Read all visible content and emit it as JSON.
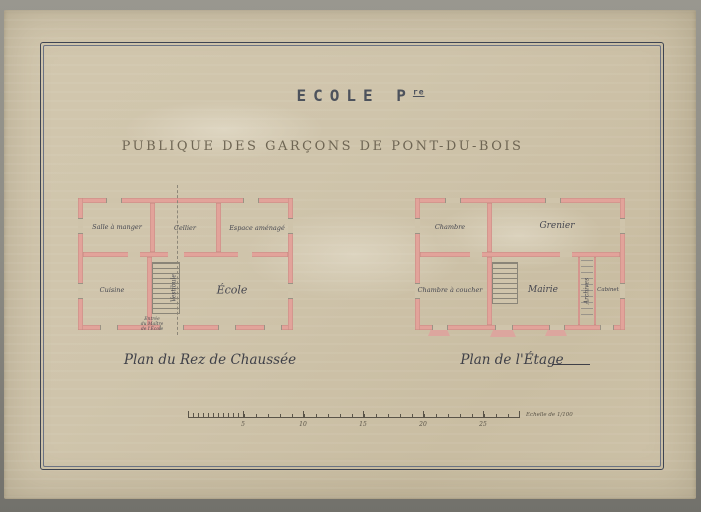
{
  "artwork": {
    "title_main": "ECOLE P",
    "title_sup": "re",
    "subtitle": "PUBLIQUE DES GARÇONS DE PONT-DU-BOIS"
  },
  "ground_floor": {
    "caption": "Plan du Rez de Chaussée",
    "rooms": {
      "salle_a_manger": "Salle à manger",
      "cellier": "Cellier",
      "espace_amenage": "Espace aménagé",
      "cuisine": "Cuisine",
      "vestibule": "Vestibule",
      "ecole": "École"
    },
    "entry_note_lines": [
      "Entrée",
      "du Maître",
      "de l'École"
    ]
  },
  "upper_floor": {
    "caption": "Plan de l'Étage",
    "rooms": {
      "chambre": "Chambre",
      "grenier": "Grenier",
      "chambre_a_coucher": "Chambre à coucher",
      "mairie": "Mairie",
      "archives": "Archives",
      "cabinet": "Cabinet"
    }
  },
  "scale_bar": {
    "ticks": [
      "5",
      "10",
      "15",
      "20",
      "25"
    ],
    "caption": "Echelle de 1/100"
  },
  "colors": {
    "paper": "#cfc4ab",
    "wall_pink": "#e2a39a",
    "ink_dark": "#45464f",
    "frame": "#3e4452"
  }
}
